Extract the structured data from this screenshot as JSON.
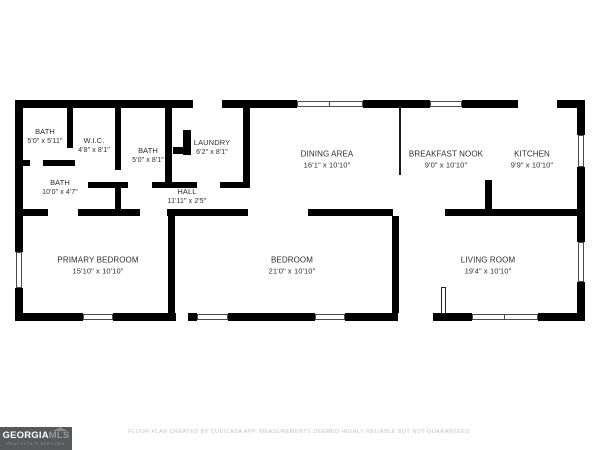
{
  "colors": {
    "wall": "#000000",
    "background": "#ffffff",
    "label_text": "#2e2e2e",
    "logo_bg": "#58595b",
    "disclaimer_text": "#c2c2c2"
  },
  "rooms": [
    {
      "name": "BATH",
      "dims": "5'0\" x 5'11\""
    },
    {
      "name": "W.I.C.",
      "dims": "4'8\" x 8'1\""
    },
    {
      "name": "BATH",
      "dims": "5'0\" x 8'1\""
    },
    {
      "name": "LAUNDRY",
      "dims": "6'2\" x 8'1\""
    },
    {
      "name": "BATH",
      "dims": "10'0\" x 4'7\""
    },
    {
      "name": "HALL",
      "dims": "11'11\" x 2'5\""
    },
    {
      "name": "DINING AREA",
      "dims": "16'1\" x 10'10\""
    },
    {
      "name": "BREAKFAST NOOK",
      "dims": "9'0\" x 10'10\""
    },
    {
      "name": "KITCHEN",
      "dims": "9'9\" x 10'10\""
    },
    {
      "name": "PRIMARY BEDROOM",
      "dims": "15'10\" x 10'10\""
    },
    {
      "name": "BEDROOM",
      "dims": "21'0\" x 10'10\""
    },
    {
      "name": "LIVING ROOM",
      "dims": "19'4\" x 10'10\""
    }
  ],
  "logo": {
    "brand": "GEORGIA",
    "brand_suffix": "MLS",
    "tagline": "REAL ESTATE SERVICES"
  },
  "footer": {
    "disclaimer": "FLOOR PLAN CREATED BY CUBICASA APP. MEASUREMENTS DEEMED HIGHLY RELIABLE BUT NOT GUARANTEED."
  }
}
